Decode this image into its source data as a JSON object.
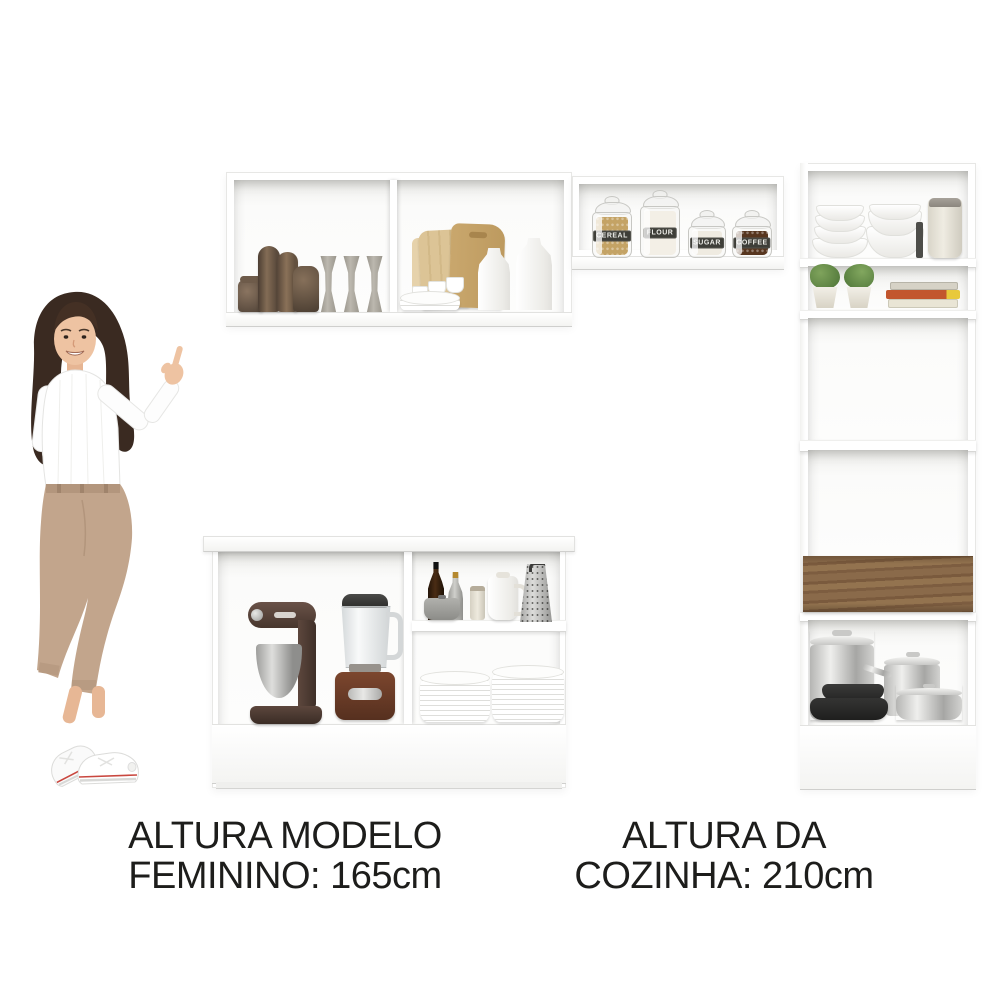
{
  "captions": {
    "left": {
      "line1": "ALTURA MODELO",
      "line2": "FEMININO: 165cm"
    },
    "right": {
      "line1": "ALTURA DA",
      "line2": "COZINHA: 210cm"
    }
  },
  "jars": [
    {
      "label": "CEREAL",
      "contents_color": "#c4a365"
    },
    {
      "label": "FLOUR",
      "contents_color": "#f3efe6"
    },
    {
      "label": "SUGAR",
      "contents_color": "#efebe1"
    },
    {
      "label": "COFFEE",
      "contents_color": "#57361f"
    }
  ],
  "books": [
    {
      "color": "#d6d2c6"
    },
    {
      "color": "#c2562e"
    },
    {
      "color": "#e9e5d5"
    }
  ],
  "colors": {
    "background": "#ffffff",
    "cabinet": "#ffffff",
    "drawer_wood": "#85674b",
    "jar_label_bg": "#3e3e38",
    "caption_text": "#1d1d1b"
  }
}
